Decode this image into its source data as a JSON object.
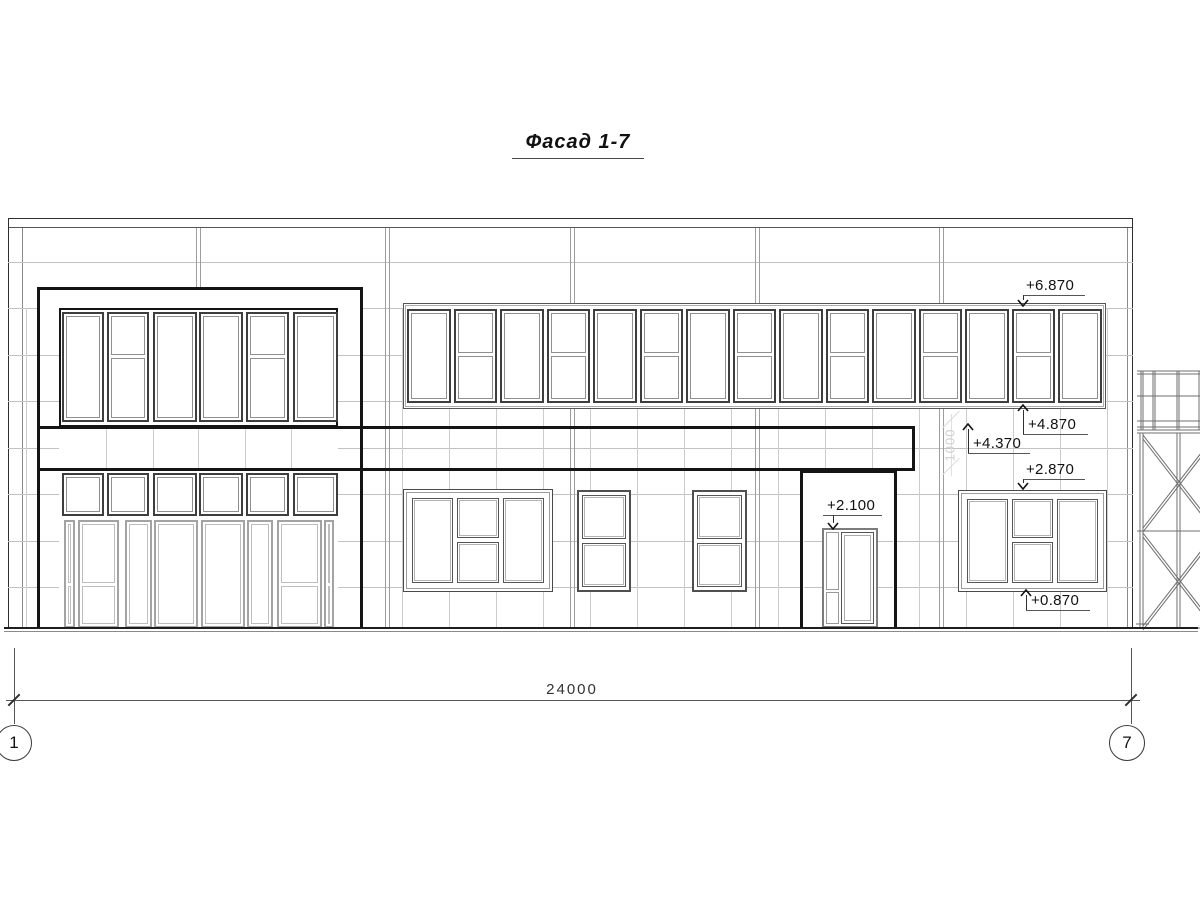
{
  "title": "Фасад 1-7",
  "dimension": {
    "total_width_label": "24000"
  },
  "axes": [
    {
      "label": "1"
    },
    {
      "label": "7"
    }
  ],
  "elevation_marks": [
    {
      "id": "top_band_top",
      "value": "+6.870",
      "direction": "down"
    },
    {
      "id": "top_band_bottom",
      "value": "+4.870",
      "direction": "up"
    },
    {
      "id": "canopy_top",
      "value": "+4.370",
      "direction": "up"
    },
    {
      "id": "right_window_top",
      "value": "+2.870",
      "direction": "down"
    },
    {
      "id": "door_top",
      "value": "+2.100",
      "direction": "down"
    },
    {
      "id": "right_window_sill",
      "value": "+0.870",
      "direction": "up"
    }
  ],
  "watermark": {
    "text": "1000"
  },
  "colors": {
    "line_bold": "#141414",
    "line_outline": "#2e2e2e",
    "line_panel_joint": "#c2c2c2",
    "line_window_frame": "#3e3e3e",
    "background": "#ffffff"
  }
}
